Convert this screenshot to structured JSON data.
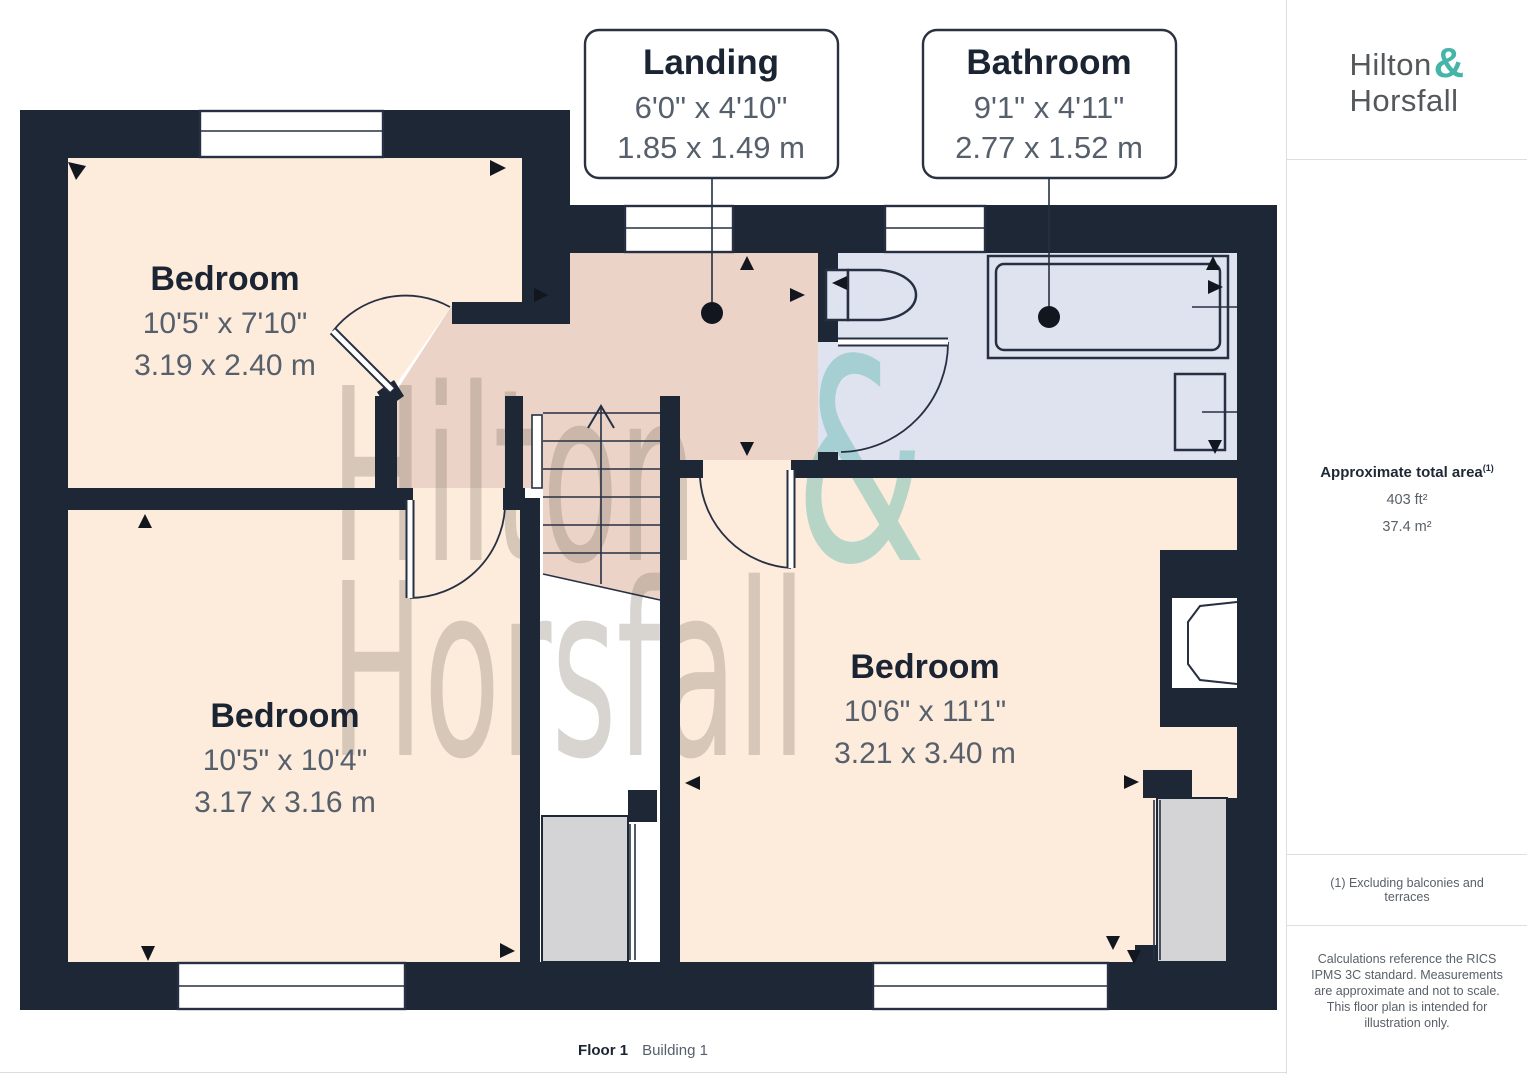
{
  "branding": {
    "name_first": "Hilton",
    "amp": "&",
    "name_second": "Horsfall"
  },
  "floor_plan": {
    "rooms": [
      {
        "name": "Bedroom",
        "imperial": "10'5\" x 7'10\"",
        "metric": "3.19 x 2.40 m"
      },
      {
        "name": "Bedroom",
        "imperial": "10'5\" x 10'4\"",
        "metric": "3.17 x 3.16 m"
      },
      {
        "name": "Bedroom",
        "imperial": "10'6\" x 11'1\"",
        "metric": "3.21 x 3.40 m"
      }
    ],
    "callouts": [
      {
        "name": "Landing",
        "imperial": "6'0\" x 4'10\"",
        "metric": "1.85 x 1.49 m"
      },
      {
        "name": "Bathroom",
        "imperial": "9'1\" x 4'11\"",
        "metric": "2.77 x 1.52 m"
      }
    ],
    "watermark": {
      "line1": "Hilton",
      "amp": "&",
      "line2": "Horsfall"
    }
  },
  "sidebar": {
    "area": {
      "title": "Approximate total area",
      "superscript": "(1)",
      "imperial": "403 ft²",
      "metric": "37.4 m²"
    },
    "footnote": "(1) Excluding balconies and terraces",
    "disclaimer": "Calculations reference the RICS IPMS 3C standard. Measurements are approximate and not to scale. This floor plan is intended for illustration only."
  },
  "footer": {
    "floor": "Floor 1",
    "building": "Building 1"
  },
  "colors": {
    "wall": "#1e2735",
    "peach": "#fdecdb",
    "salmon": "#ecd3c7",
    "bath": "#dfe3ef",
    "gray": "#d4d4d6",
    "accent": "#45b5a9",
    "ink": "#1a2433",
    "dim": "#565f6c",
    "wm": "#8a7f72",
    "wmamp": "#4fb3a9"
  }
}
